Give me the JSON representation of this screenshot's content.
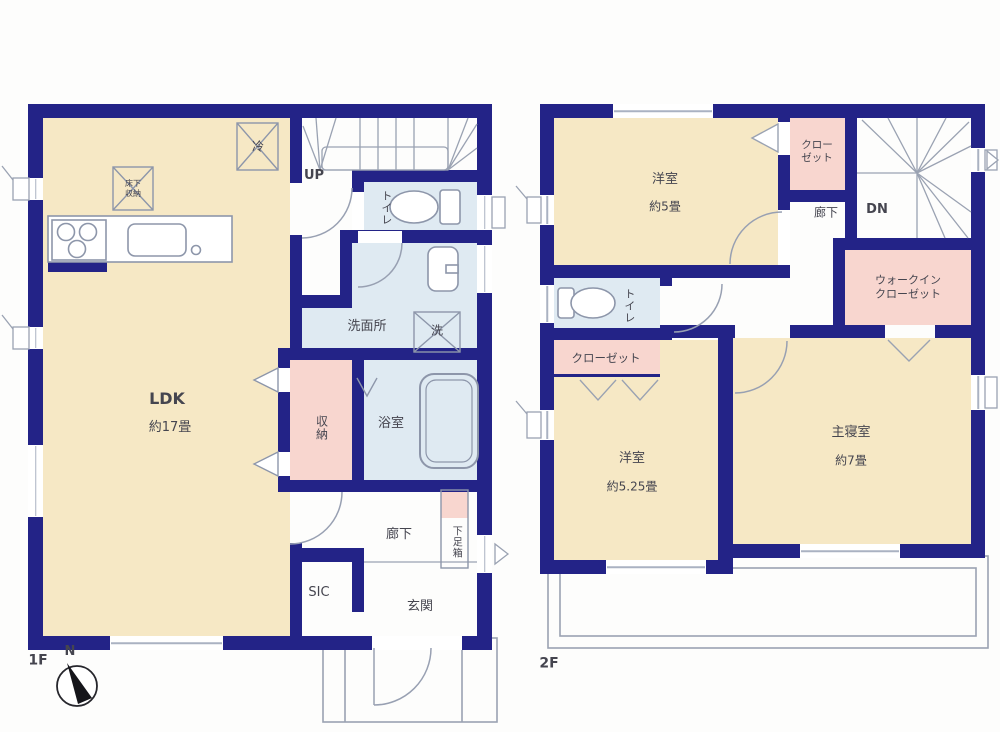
{
  "palette": {
    "wall_navy": "#232387",
    "room_cream": "#f6e8c5",
    "wet_area_blue": "#dfeaf2",
    "closet_pink": "#f8d6cf",
    "fixture_line_gray": "#8d96aa",
    "text_gray": "#45454f"
  },
  "floor1": {
    "label": "1F",
    "compass": "N",
    "stairs_label": "UP",
    "rooms": {
      "ldk": {
        "name": "LDK",
        "area": "約17畳"
      },
      "toilet": {
        "name": "トイレ"
      },
      "washroom": {
        "name": "洗面所"
      },
      "bath": {
        "name": "浴室"
      },
      "storage": {
        "name": "収納"
      },
      "hallway": {
        "name": "廊下"
      },
      "shoe_cabinet": {
        "name": "下足箱"
      },
      "shoe_closet": {
        "name": "SIC"
      },
      "entrance": {
        "name": "玄関"
      }
    },
    "fixtures": {
      "refrigerator": "冷",
      "underfloor_storage": "床下収納",
      "washing_machine": "洗"
    }
  },
  "floor2": {
    "label": "2F",
    "stairs_label": "DN",
    "rooms": {
      "western_room_5": {
        "name": "洋室",
        "area": "約5畳"
      },
      "closet_upper": {
        "name": "クローゼット"
      },
      "hallway": {
        "name": "廊下"
      },
      "walk_in_closet": {
        "name": "ウォークインクローゼット"
      },
      "toilet": {
        "name": "トイレ"
      },
      "closet_lower": {
        "name": "クローゼット"
      },
      "western_room_525": {
        "name": "洋室",
        "area": "約5.25畳"
      },
      "master_bedroom": {
        "name": "主寝室",
        "area": "約7畳"
      }
    }
  }
}
